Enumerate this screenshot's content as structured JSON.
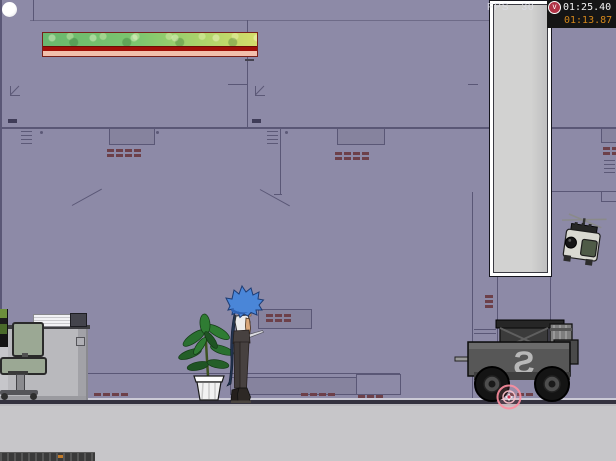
{
  "hud": {
    "fps": {
      "label": "FPS",
      "value": "30"
    },
    "timer": {
      "primary": "01:25.40",
      "secondary": "01:13.87",
      "icon": "clock-toggle-circle",
      "icon_glyph": "v"
    },
    "health_bar": {
      "percent_full": 100
    }
  },
  "scene": {
    "cart_emblem": "S",
    "sprites": [
      "white-ball",
      "player",
      "potted-plant",
      "office-desk",
      "office-chair",
      "paper-stack",
      "cargo-cart",
      "hover-drone",
      "target-reticle",
      "conveyor-strip"
    ]
  },
  "colors": {
    "wall": "#8d8aa7",
    "wall_seam": "#5a5776",
    "floor": "#c7c6c9",
    "health_green": "#7dc66f",
    "health_yellow": "#d5dd6a",
    "health_red": "#a01008",
    "health_pink": "#f2c0ac",
    "timer_bg": "#151515",
    "timer_secondary_text": "#d4871b",
    "reticle": "#ff8fa0",
    "player_hair": "#4a86d8"
  }
}
